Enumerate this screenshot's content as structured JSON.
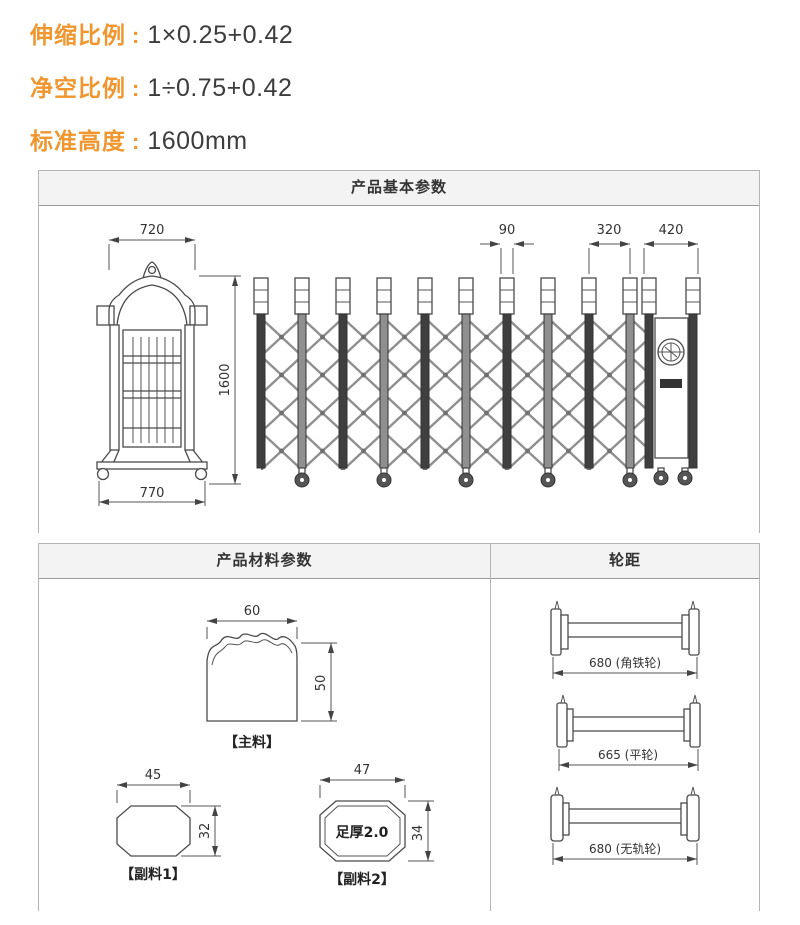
{
  "ui": {
    "colon": ":"
  },
  "specs": [
    {
      "label": "伸缩比例",
      "value": "1×0.25+0.42"
    },
    {
      "label": "净空比例",
      "value": "1÷0.75+0.42"
    },
    {
      "label": "标准高度",
      "value": "1600mm"
    }
  ],
  "panel_basic": {
    "title": "产品基本参数",
    "dims": {
      "post_top_width": "720",
      "rail_pitch_small": "90",
      "unit_pitch": "320",
      "drive_unit_width": "420",
      "height": "1600",
      "base_width": "770"
    }
  },
  "panel_material": {
    "title": "产品材料参数",
    "main_profile": {
      "width": "60",
      "height": "50",
      "label": "【主料】"
    },
    "sub_profile_1": {
      "width": "45",
      "height": "32",
      "label": "【副料1】"
    },
    "sub_profile_2": {
      "width": "47",
      "height": "34",
      "label": "【副料2】",
      "note": "足厚2.0"
    }
  },
  "panel_wheel": {
    "title": "轮距",
    "items": [
      {
        "value": "680",
        "type": "角铁轮",
        "text": "680 (角铁轮)"
      },
      {
        "value": "665",
        "type": "平轮",
        "text": "665 (平轮)"
      },
      {
        "value": "680",
        "type": "无轨轮",
        "text": "680 (无轨轮)"
      }
    ]
  },
  "colors": {
    "accent_orange": "#f0962f",
    "value_text": "#3c3c3c",
    "panel_border": "#b5b5b5",
    "panel_header_bg": "#f3f3f3",
    "drawing_line": "#4a4a4a"
  }
}
